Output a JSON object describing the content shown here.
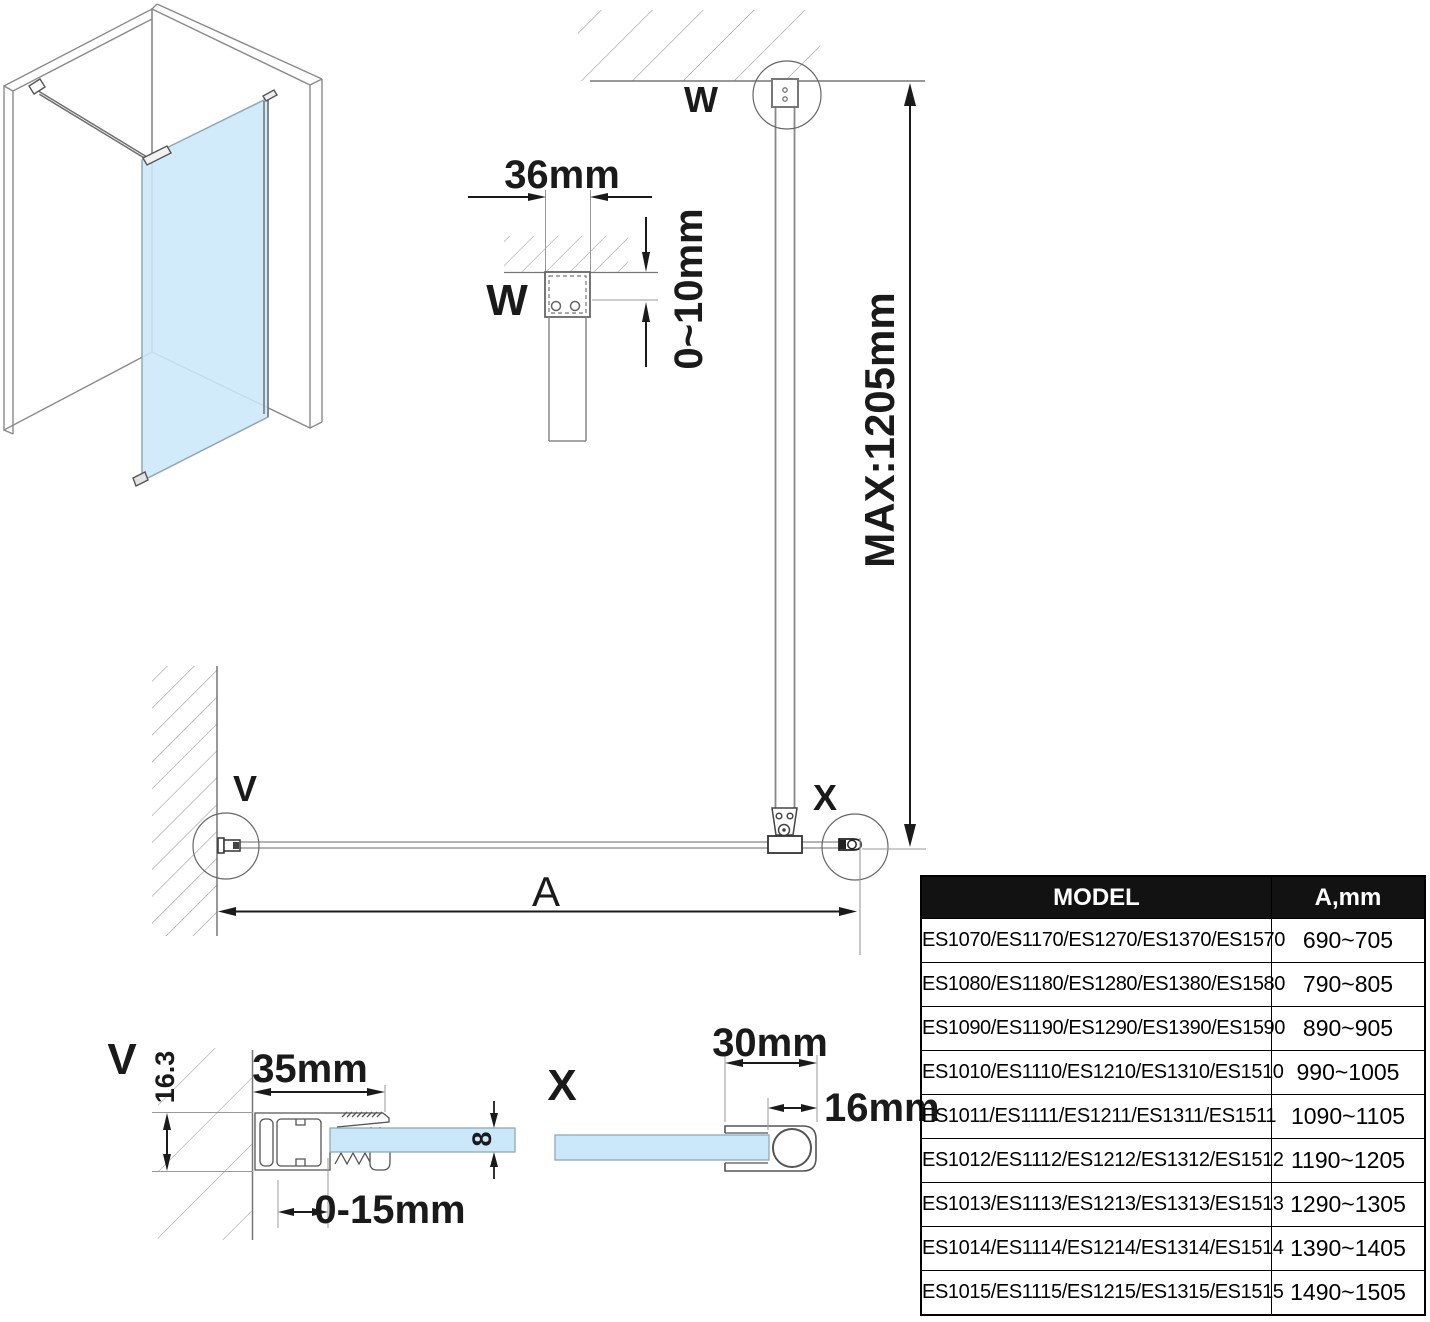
{
  "colors": {
    "glass": "#cbe8fa",
    "line_gray": "#808080",
    "dim_black": "#1a1a1a",
    "hatch_gray": "#999999",
    "table_header_bg": "#121212"
  },
  "labels": {
    "v_plan": "V",
    "w_plan": "W",
    "x_plan": "X",
    "v_detail": "V",
    "w_detail": "W",
    "x_detail": "X",
    "a_dim": "A"
  },
  "dims": {
    "bracket_width": "36mm",
    "ceiling_gap": "0~10mm",
    "max_bar": "MAX:1205mm",
    "profile_width": "35mm",
    "profile_height": "16.3",
    "glass_thickness": "8",
    "wall_adjust": "0-15mm",
    "clamp_length": "30mm",
    "clamp_insert": "16mm"
  },
  "table": {
    "header": {
      "model": "MODEL",
      "a": "A,mm"
    },
    "rows": [
      {
        "model": "ES1070/ES1170/ES1270/ES1370/ES1570",
        "a": "690~705"
      },
      {
        "model": "ES1080/ES1180/ES1280/ES1380/ES1580",
        "a": "790~805"
      },
      {
        "model": "ES1090/ES1190/ES1290/ES1390/ES1590",
        "a": "890~905"
      },
      {
        "model": "ES1010/ES1110/ES1210/ES1310/ES1510",
        "a": "990~1005"
      },
      {
        "model": "ES1011/ES1111/ES1211/ES1311/ES1511",
        "a": "1090~1105"
      },
      {
        "model": "ES1012/ES1112/ES1212/ES1312/ES1512",
        "a": "1190~1205"
      },
      {
        "model": "ES1013/ES1113/ES1213/ES1313/ES1513",
        "a": "1290~1305"
      },
      {
        "model": "ES1014/ES1114/ES1214/ES1314/ES1514",
        "a": "1390~1405"
      },
      {
        "model": "ES1015/ES1115/ES1215/ES1315/ES1515",
        "a": "1490~1505"
      }
    ]
  }
}
